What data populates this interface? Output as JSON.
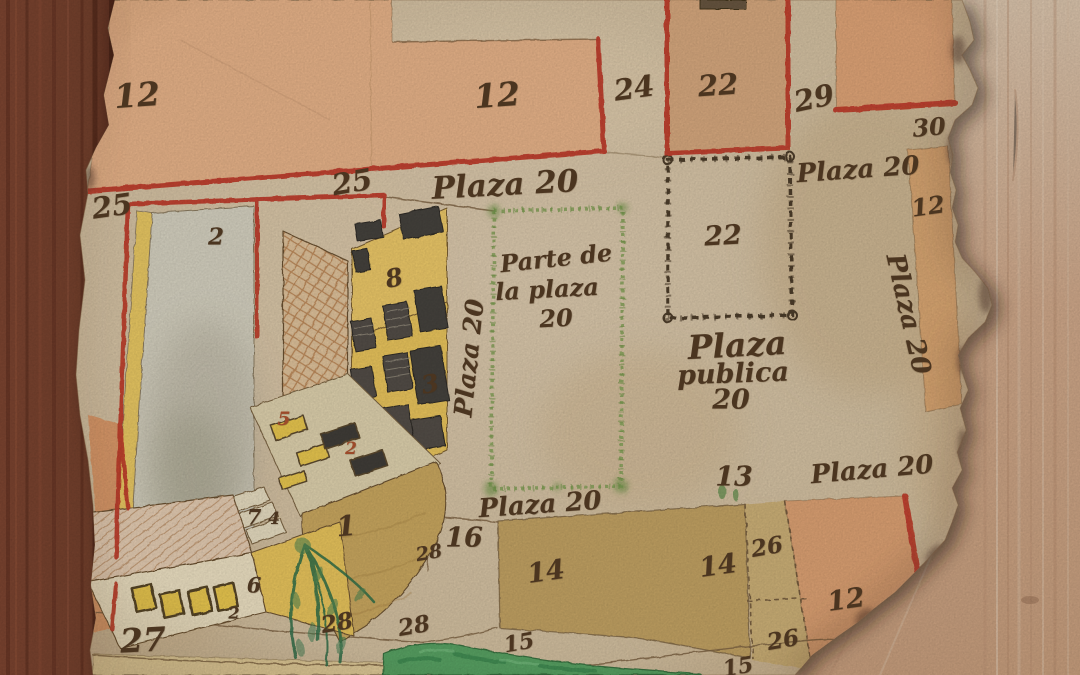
{
  "map": {
    "type": "historical-town-plan",
    "features": [
      "wood-frame-left",
      "wood-backing-right",
      "parchment-sheet",
      "building-complex",
      "chained-lot-22",
      "green-plaza-outline",
      "plaza-ground-fan",
      "tree",
      "pond",
      "numbered-lots"
    ],
    "colors": {
      "parchment": "#d5c2a4",
      "wood_dark_frame": "#6f3a2a",
      "wood_light": "#cfa88a",
      "boundary_red": "#c03e2c",
      "ink": "#4b3520",
      "plot_salmon": "#e7b389",
      "plot_tan": "#d6a87e",
      "plot_khaki": "#c2a264",
      "plot_orange": "#dca173",
      "building_yellow": "#eac75d",
      "brick": "#bb8758",
      "plaza_border_green": "#84a158",
      "pond_green": "#55a05e",
      "tree_green": "#2f6e49",
      "chain_ink": "#4d3d2a"
    },
    "labels": [
      {
        "text": "Plaza 20",
        "x": 505,
        "y": 185,
        "s": 31,
        "r": -3,
        "n": "street-label"
      },
      {
        "text": "Plaza 20",
        "x": 858,
        "y": 170,
        "s": 26,
        "r": -4,
        "n": "street-label"
      },
      {
        "text": "Plaza 20",
        "x": 908,
        "y": 314,
        "s": 26,
        "r": 77,
        "n": "street-label"
      },
      {
        "text": "Plaza 20",
        "x": 469,
        "y": 358,
        "s": 25,
        "r": -84,
        "n": "street-label"
      },
      {
        "text": "Plaza 20",
        "x": 540,
        "y": 505,
        "s": 26,
        "r": -4,
        "n": "street-label"
      },
      {
        "text": "Plaza 20",
        "x": 872,
        "y": 470,
        "s": 26,
        "r": -5,
        "n": "street-label"
      },
      {
        "text": "Parte de",
        "x": 556,
        "y": 258,
        "s": 24,
        "r": -6,
        "n": "plaza-area-label"
      },
      {
        "text": "la plaza",
        "x": 547,
        "y": 289,
        "s": 24,
        "r": -3,
        "n": "plaza-area-label"
      },
      {
        "text": "20",
        "x": 556,
        "y": 318,
        "s": 24,
        "r": -3,
        "n": "plaza-area-label"
      },
      {
        "text": "Plaza",
        "x": 737,
        "y": 345,
        "s": 33,
        "r": -3,
        "n": "plaza-area-label"
      },
      {
        "text": "publica",
        "x": 733,
        "y": 374,
        "s": 27,
        "r": -2,
        "n": "plaza-area-label"
      },
      {
        "text": "20",
        "x": 731,
        "y": 400,
        "s": 27,
        "r": 0,
        "n": "plaza-area-label"
      },
      {
        "text": "12",
        "x": 137,
        "y": 95,
        "s": 33,
        "r": -4,
        "n": "plot-number"
      },
      {
        "text": "12",
        "x": 497,
        "y": 95,
        "s": 33,
        "r": -4,
        "n": "plot-number"
      },
      {
        "text": "24",
        "x": 634,
        "y": 88,
        "s": 29,
        "r": -8,
        "n": "plot-number"
      },
      {
        "text": "22",
        "x": 718,
        "y": 85,
        "s": 29,
        "r": -4,
        "n": "plot-number"
      },
      {
        "text": "29",
        "x": 814,
        "y": 98,
        "s": 29,
        "r": -12,
        "n": "plot-number"
      },
      {
        "text": "30",
        "x": 929,
        "y": 127,
        "s": 24,
        "r": -5,
        "n": "plot-number"
      },
      {
        "text": "12",
        "x": 928,
        "y": 206,
        "s": 24,
        "r": -8,
        "n": "plot-number"
      },
      {
        "text": "25",
        "x": 112,
        "y": 206,
        "s": 29,
        "r": -8,
        "n": "plot-number"
      },
      {
        "text": "25",
        "x": 352,
        "y": 182,
        "s": 29,
        "r": -10,
        "n": "plot-number"
      },
      {
        "text": "2",
        "x": 216,
        "y": 237,
        "s": 23,
        "r": 0,
        "n": "plot-number"
      },
      {
        "text": "8",
        "x": 394,
        "y": 278,
        "s": 25,
        "r": -12,
        "n": "plot-number"
      },
      {
        "text": "3",
        "x": 430,
        "y": 384,
        "s": 25,
        "r": -10,
        "n": "plot-number"
      },
      {
        "text": "5",
        "x": 284,
        "y": 419,
        "s": 19,
        "r": 0,
        "c": "#9c4a2a",
        "n": "plot-number"
      },
      {
        "text": "2",
        "x": 351,
        "y": 449,
        "s": 17,
        "r": 0,
        "c": "#9c4a2a",
        "n": "plot-number"
      },
      {
        "text": "7",
        "x": 254,
        "y": 517,
        "s": 21,
        "r": 0,
        "n": "plot-number"
      },
      {
        "text": "4",
        "x": 274,
        "y": 519,
        "s": 17,
        "r": 0,
        "n": "plot-number"
      },
      {
        "text": "1",
        "x": 346,
        "y": 526,
        "s": 28,
        "r": -5,
        "n": "plot-number"
      },
      {
        "text": "6",
        "x": 254,
        "y": 585,
        "s": 21,
        "r": 0,
        "n": "plot-number"
      },
      {
        "text": "2",
        "x": 234,
        "y": 613,
        "s": 16,
        "r": 0,
        "n": "plot-number"
      },
      {
        "text": "27",
        "x": 143,
        "y": 640,
        "s": 33,
        "r": -3,
        "w": 700,
        "n": "plot-number"
      },
      {
        "text": "28",
        "x": 337,
        "y": 623,
        "s": 23,
        "r": -10,
        "n": "plot-number"
      },
      {
        "text": "28",
        "x": 414,
        "y": 626,
        "s": 23,
        "r": -10,
        "n": "plot-number"
      },
      {
        "text": "28",
        "x": 429,
        "y": 553,
        "s": 19,
        "r": -10,
        "n": "plot-number"
      },
      {
        "text": "16",
        "x": 464,
        "y": 538,
        "s": 27,
        "r": 0,
        "n": "plot-number"
      },
      {
        "text": "22",
        "x": 723,
        "y": 236,
        "s": 27,
        "r": -3,
        "n": "plot-number"
      },
      {
        "text": "13",
        "x": 734,
        "y": 477,
        "s": 27,
        "r": 0,
        "n": "plot-number"
      },
      {
        "text": "14",
        "x": 546,
        "y": 572,
        "s": 27,
        "r": -8,
        "n": "plot-number"
      },
      {
        "text": "14",
        "x": 718,
        "y": 566,
        "s": 27,
        "r": -8,
        "n": "plot-number"
      },
      {
        "text": "26",
        "x": 767,
        "y": 547,
        "s": 23,
        "r": -10,
        "n": "plot-number"
      },
      {
        "text": "26",
        "x": 783,
        "y": 640,
        "s": 23,
        "r": -10,
        "n": "plot-number"
      },
      {
        "text": "12",
        "x": 846,
        "y": 600,
        "s": 27,
        "r": -8,
        "n": "plot-number"
      },
      {
        "text": "15",
        "x": 519,
        "y": 643,
        "s": 22,
        "r": -10,
        "n": "plot-number"
      },
      {
        "text": "15",
        "x": 738,
        "y": 667,
        "s": 22,
        "r": -10,
        "n": "plot-number"
      }
    ]
  }
}
